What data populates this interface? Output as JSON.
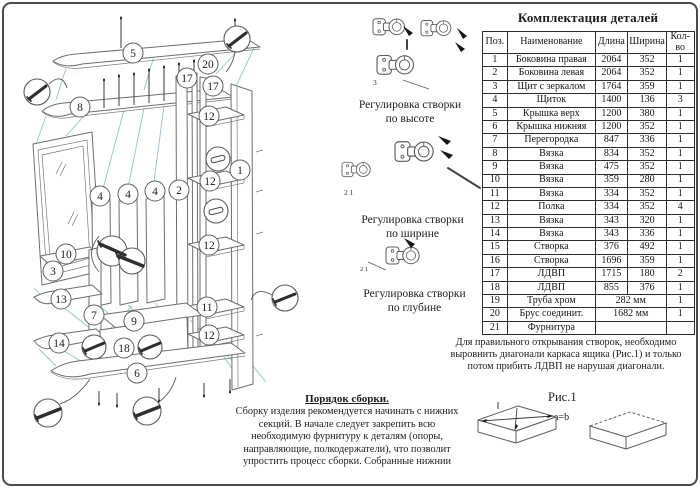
{
  "parts_table": {
    "title": "Комплектация деталей",
    "columns": [
      "Поз.",
      "Наименование",
      "Длина",
      "Ширина",
      "Кол-во"
    ],
    "rows": [
      {
        "pos": "1",
        "name": "Боковина правая",
        "len": "2064",
        "wid": "352",
        "qty": "1",
        "span": false
      },
      {
        "pos": "2",
        "name": "Боковина левая",
        "len": "2064",
        "wid": "352",
        "qty": "1",
        "span": false
      },
      {
        "pos": "3",
        "name": "Щит с зеркалом",
        "len": "1764",
        "wid": "359",
        "qty": "1",
        "span": false
      },
      {
        "pos": "4",
        "name": "Щиток",
        "len": "1400",
        "wid": "136",
        "qty": "3",
        "span": false
      },
      {
        "pos": "5",
        "name": "Крышка верх",
        "len": "1200",
        "wid": "380",
        "qty": "1",
        "span": false
      },
      {
        "pos": "6",
        "name": "Крышка нижняя",
        "len": "1200",
        "wid": "352",
        "qty": "1",
        "span": false
      },
      {
        "pos": "7",
        "name": "Перегородка",
        "len": "847",
        "wid": "336",
        "qty": "1",
        "span": false
      },
      {
        "pos": "8",
        "name": "Вязка",
        "len": "834",
        "wid": "352",
        "qty": "1",
        "span": false
      },
      {
        "pos": "9",
        "name": "Вязка",
        "len": "475",
        "wid": "352",
        "qty": "1",
        "span": false
      },
      {
        "pos": "10",
        "name": "Вязка",
        "len": "359",
        "wid": "280",
        "qty": "1",
        "span": false
      },
      {
        "pos": "11",
        "name": "Вязка",
        "len": "334",
        "wid": "352",
        "qty": "1",
        "span": false
      },
      {
        "pos": "12",
        "name": "Полка",
        "len": "334",
        "wid": "352",
        "qty": "4",
        "span": false
      },
      {
        "pos": "13",
        "name": "Вязка",
        "len": "343",
        "wid": "320",
        "qty": "1",
        "span": false
      },
      {
        "pos": "14",
        "name": "Вязка",
        "len": "343",
        "wid": "336",
        "qty": "1",
        "span": false
      },
      {
        "pos": "15",
        "name": "Створка",
        "len": "376",
        "wid": "492",
        "qty": "1",
        "span": false
      },
      {
        "pos": "16",
        "name": "Створка",
        "len": "1696",
        "wid": "359",
        "qty": "1",
        "span": false
      },
      {
        "pos": "17",
        "name": "ЛДВП",
        "len": "1715",
        "wid": "180",
        "qty": "2",
        "span": false
      },
      {
        "pos": "18",
        "name": "ЛДВП",
        "len": "855",
        "wid": "376",
        "qty": "1",
        "span": false
      },
      {
        "pos": "19",
        "name": "Труба хром",
        "len": "282 мм",
        "wid": "",
        "qty": "1",
        "span": true
      },
      {
        "pos": "20",
        "name": "Брус соединит.",
        "len": "1682 мм",
        "wid": "",
        "qty": "1",
        "span": true
      },
      {
        "pos": "21",
        "name": "Фурнитура",
        "len": "",
        "wid": "",
        "qty": "",
        "span": true
      }
    ]
  },
  "adjustments": [
    {
      "line1": "Регулировка створки",
      "line2": "по высоте",
      "callout": "3"
    },
    {
      "line1": "Регулировка створки",
      "line2": "по ширине",
      "callout": "2  1"
    },
    {
      "line1": "Регулировка створки",
      "line2": "по глубине",
      "callout": "2  1"
    }
  ],
  "note": {
    "text": "Для правильного открывания створок, необходимо выровнить диагонали каркаса ящика (Рис.1) и только потом прибить ЛДВП не нарушая диагонали."
  },
  "fig1": {
    "label": "Рис.1",
    "annotation": "a=b"
  },
  "assembly": {
    "title": "Порядок сборки.",
    "body": "Сборку изделия рекомендуется начинать с нижних секций. В начале следует закрепить всю необходимую фурнитуру к деталям (опоры, направляющие, полкодержатели), что позволит упростить процесс сборки. Собранные нижнии"
  },
  "diagram": {
    "line_color": "#6e6e6e",
    "leader_color": "#8fc6c9",
    "callouts": [
      {
        "n": "5",
        "x": 129,
        "y": 49
      },
      {
        "n": "8",
        "x": 76,
        "y": 103
      },
      {
        "n": "20",
        "x": 204,
        "y": 60
      },
      {
        "n": "17",
        "x": 183,
        "y": 74
      },
      {
        "n": "17",
        "x": 209,
        "y": 82
      },
      {
        "n": "12",
        "x": 205,
        "y": 112
      },
      {
        "n": "12",
        "x": 206,
        "y": 177
      },
      {
        "n": "12",
        "x": 205,
        "y": 241
      },
      {
        "n": "11",
        "x": 203,
        "y": 303
      },
      {
        "n": "12",
        "x": 205,
        "y": 331
      },
      {
        "n": "1",
        "x": 236,
        "y": 166
      },
      {
        "n": "2",
        "x": 175,
        "y": 186
      },
      {
        "n": "4",
        "x": 96,
        "y": 192
      },
      {
        "n": "4",
        "x": 124,
        "y": 190
      },
      {
        "n": "4",
        "x": 151,
        "y": 187
      },
      {
        "n": "10",
        "x": 62,
        "y": 250
      },
      {
        "n": "3",
        "x": 49,
        "y": 267
      },
      {
        "n": "13",
        "x": 57,
        "y": 295
      },
      {
        "n": "7",
        "x": 90,
        "y": 311
      },
      {
        "n": "9",
        "x": 130,
        "y": 317
      },
      {
        "n": "14",
        "x": 55,
        "y": 339
      },
      {
        "n": "18",
        "x": 120,
        "y": 344
      },
      {
        "n": "6",
        "x": 133,
        "y": 369
      }
    ]
  }
}
